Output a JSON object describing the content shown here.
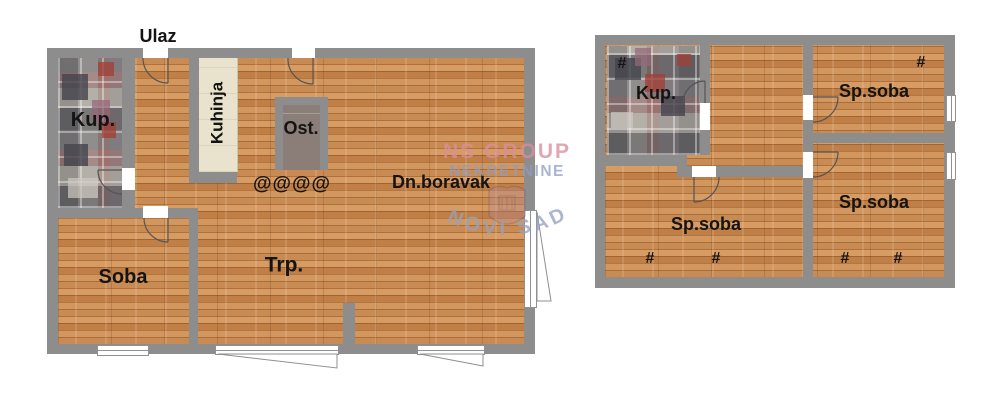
{
  "watermark": {
    "line1": "NS GROUP",
    "line2": "NEKRETNINE",
    "arc_text": "NOVI SAD"
  },
  "plans": {
    "ground": {
      "entrance": "Ulaz",
      "bathroom": "Kup.",
      "kitchen": "Kuhinja",
      "pantry": "Ost.",
      "stairs_mark": "@@@@",
      "living_room": "Dn.boravak",
      "dining": "Trp.",
      "room": "Soba"
    },
    "upper": {
      "bathroom": "Kup.",
      "bedroom_top_right": "Sp.soba",
      "bedroom_bottom_right": "Sp.soba",
      "bedroom_bottom_left": "Sp.soba",
      "hash_mark": "#"
    }
  },
  "colors": {
    "wall": "#8d8d8d",
    "wood": "#c5864f",
    "tile_base": "#a09c96",
    "kitchen_counter": "#e9e3cd",
    "pantry_fill": "#8b7d77",
    "label": "#141414",
    "door_line": "#555555",
    "window_line": "#909090",
    "watermark_pink": "#d98f9b",
    "watermark_blue": "#8f9cc4",
    "watermark_gray": "#97a2bc"
  }
}
